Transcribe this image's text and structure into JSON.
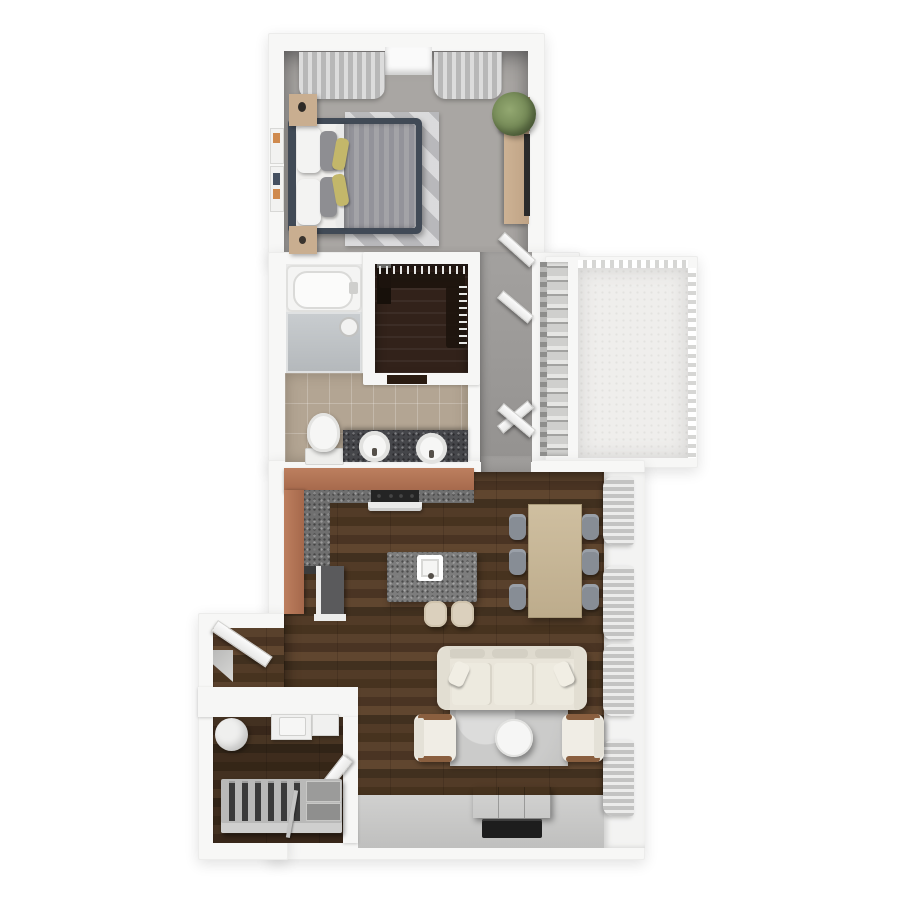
{
  "scene": {
    "type": "3d-floor-plan-render",
    "view": "top-down dollhouse",
    "unit": "one-bedroom apartment with balcony",
    "visible_text": "none"
  },
  "palette": {
    "background": "#ffffff",
    "walls": "#f7f7f6",
    "bedroom_carpet": "#a9a6a3",
    "bathroom_tile": "#b3a593",
    "living_wood_floor": "#4e3827",
    "closet_dark_wood": "#32221a",
    "hall_floor": "#9c9a98",
    "balcony_concrete": "#efeeec",
    "kitchen_cabinet_wood": "#b0755a",
    "countertop_speckle": "#6f6f6f",
    "sofa_cream": "#e9e5da",
    "rug_gray": "#cbcbcb",
    "dining_table_wood": "#c9b89a",
    "dining_chair_gray": "#878d95",
    "bed_frame_navy": "#414a56",
    "accent_pillow_yellow": "#c3b76a",
    "tv_black": "#1d1d1d",
    "south_wall_face": "#c6c6c5"
  },
  "rooms": {
    "bedroom": {
      "name": "Bedroom",
      "floor": "gray carpet",
      "items": [
        "double-bed",
        "white-pillows",
        "gray-accent-pillows",
        "yellow-accent-pillows",
        "striped-duvet",
        "area-rug",
        "nightstand-upper",
        "nightstand-lower",
        "dresser",
        "tv-on-dresser",
        "potted-plant",
        "curtains-left-window",
        "curtains-right-window",
        "window-recess",
        "wall-art-frames"
      ]
    },
    "bathroom": {
      "name": "Bathroom",
      "floor": "beige tile",
      "items": [
        "bathtub",
        "shower-glass-enclosure",
        "shower-head",
        "toilet",
        "double-vanity",
        "sink-left",
        "sink-right",
        "swing-door"
      ]
    },
    "walk_in_closet": {
      "name": "Walk-in Closet",
      "floor": "dark wood",
      "items": [
        "hanging-clothes-top-rail",
        "hanging-clothes-right-rail",
        "dark-dresser",
        "door-threshold"
      ]
    },
    "hallway": {
      "name": "Hallway",
      "floor": "gray",
      "items": [
        "bedroom-swing-door",
        "bifold-closet-doors"
      ]
    },
    "linen_closet": {
      "name": "Utility / Linen Closet",
      "items": [
        "shelf-stack"
      ]
    },
    "balcony": {
      "name": "Balcony",
      "floor": "white concrete",
      "items": [
        "railing-top",
        "railing-right"
      ]
    },
    "kitchen": {
      "name": "Kitchen",
      "floor": "walnut plank",
      "items": [
        "l-shaped-counter",
        "range-stove",
        "refrigerator",
        "island-with-sink",
        "barstool-1",
        "barstool-2"
      ]
    },
    "dining": {
      "name": "Dining Area",
      "items": [
        "rectangular-table",
        "chair-1",
        "chair-2",
        "chair-3",
        "chair-4",
        "chair-5",
        "chair-6"
      ]
    },
    "living": {
      "name": "Living Room",
      "floor": "walnut plank",
      "items": [
        "three-seat-sofa",
        "area-rug",
        "round-coffee-table",
        "accent-chair-left",
        "accent-chair-right",
        "media-console",
        "wall-mounted-tv",
        "curtain-bundle-1",
        "curtain-bundle-2",
        "curtain-bundle-3",
        "curtain-bundle-4"
      ]
    },
    "entry": {
      "name": "Entry",
      "items": [
        "front-door-open"
      ]
    },
    "laundry_closet": {
      "name": "Laundry / Storage Closet",
      "items": [
        "water-heater",
        "washer",
        "dryer",
        "swing-door",
        "storage-rack-with-slats",
        "broom-pole"
      ]
    }
  }
}
